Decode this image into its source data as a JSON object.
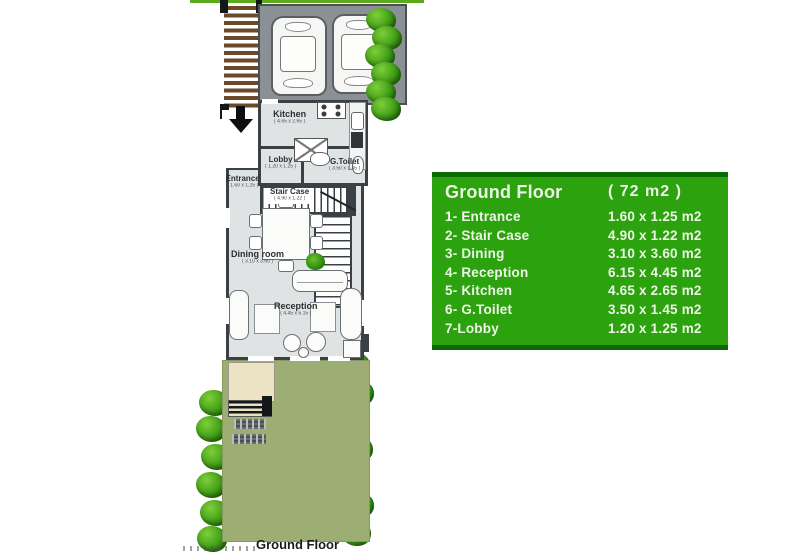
{
  "plan": {
    "caption": "Ground Floor",
    "rooms": {
      "kitchen": {
        "name": "Kitchen",
        "dims": "( 4.65 x 2.65 )"
      },
      "lobby": {
        "name": "Lobby",
        "dims": "( 1.20 x 1.25 )"
      },
      "gtoilet": {
        "name": "G.Toilet",
        "dims": "( 3.50 x 1.45 )"
      },
      "entrance": {
        "name": "Entrance",
        "dims": "( 1.60 x 1.25 )"
      },
      "staircase": {
        "name": "Stair Case",
        "dims": "( 4.90 x 1.22 )"
      },
      "dining": {
        "name": "Dining room",
        "dims": "( 3.10 x 3.60 )"
      },
      "reception": {
        "name": "Reception",
        "dims": "( 4.45 x 6.15 )"
      }
    }
  },
  "legend": {
    "title": "Ground Floor",
    "area": "( 72 m2 )",
    "rows": [
      {
        "label": "1- Entrance",
        "size": "1.60 x 1.25 m2"
      },
      {
        "label": "2- Stair Case",
        "size": "4.90 x 1.22 m2"
      },
      {
        "label": "3- Dining",
        "size": "3.10 x 3.60 m2"
      },
      {
        "label": "4- Reception",
        "size": "6.15 x 4.45 m2"
      },
      {
        "label": "5- Kitchen",
        "size": "4.65 x 2.65 m2"
      },
      {
        "label": "6- G.Toilet",
        "size": "3.50 x 1.45 m2"
      },
      {
        "label": "7-Lobby",
        "size": "1.20 x 1.25 m2"
      }
    ],
    "colors": {
      "background": "#2ca20f",
      "stripe": "#0c6a03",
      "text": "#edf6e6"
    }
  },
  "palette": {
    "interior": "#dfe3e4",
    "wall": "#3a4045",
    "garage": "#8a9094",
    "garden": "#9dae74",
    "terrace": "#ebe3c3",
    "pergola": "#6b4a29",
    "tree": "#3f9c16",
    "topline": "#5ca91d"
  }
}
